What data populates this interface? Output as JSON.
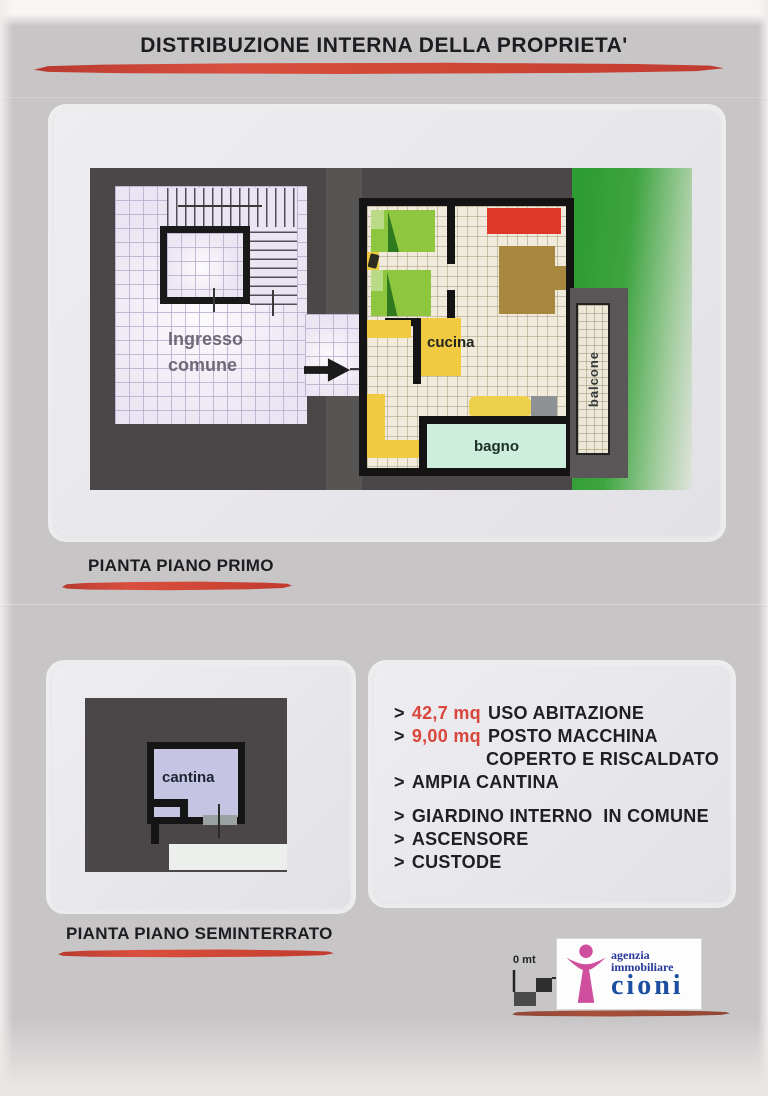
{
  "page": {
    "title": "DISTRIBUZIONE INTERNA DELLA PROPRIETA'",
    "plan1_caption": "PIANTA PIANO PRIMO",
    "plan2_caption": "PIANTA PIANO SEMINTERRATO"
  },
  "plan_primo": {
    "ingresso_line1": "Ingresso",
    "ingresso_line2": "comune",
    "cucina_label": "cucina",
    "bagno_label": "bagno",
    "balcone_label": "balcone"
  },
  "plan_seminterrato": {
    "cantina_label": "cantina"
  },
  "features": {
    "lines": [
      {
        "bullet": ">",
        "value": "42,7 mq",
        "text": "USO ABITAZIONE"
      },
      {
        "bullet": ">",
        "value": "9,00 mq",
        "text": "POSTO MACCHINA"
      },
      {
        "bullet": "",
        "value": "",
        "text": "COPERTO E RISCALDATO"
      },
      {
        "bullet": ">",
        "value": "",
        "text": "AMPIA CANTINA"
      },
      {
        "bullet": ">",
        "value": "",
        "text": "GIARDINO INTERNO  IN COMUNE"
      },
      {
        "bullet": ">",
        "value": "",
        "text": "ASCENSORE"
      },
      {
        "bullet": ">",
        "value": "",
        "text": "CUSTODE"
      }
    ]
  },
  "scale": {
    "zero_label": "0 mt"
  },
  "logo": {
    "line1": "agenzia",
    "line2": "immobiliare",
    "name": "cioni"
  },
  "colors": {
    "accent_red": "#d1473a",
    "plan_dark": "#4b4748",
    "garden_green": "#35a038",
    "bed_green": "#8ec63f",
    "sofa_red": "#e0382b",
    "kitchen_yellow": "#f0cb42",
    "bath_mint": "#cdeedd",
    "tile_lavender": "#ebe4f2",
    "cantina_lavender": "#c6c4e3",
    "logo_pink": "#cf4f9e",
    "logo_blue": "#1c4fa0",
    "underline_brown": "#a6503c"
  }
}
